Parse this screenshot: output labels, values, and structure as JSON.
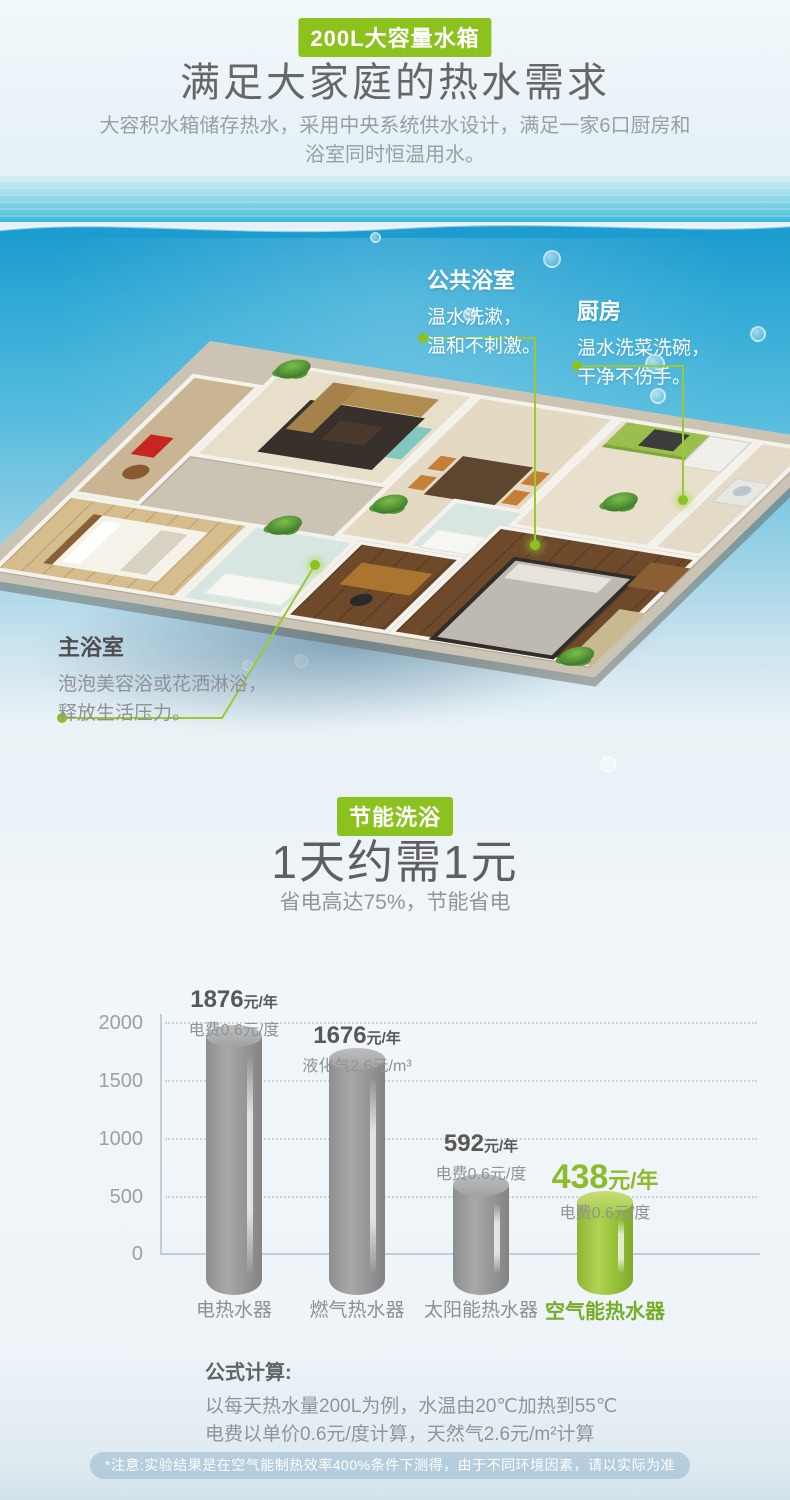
{
  "header": {
    "badge": "200L大容量水箱",
    "title": "满足大家庭的热水需求",
    "desc": "大容积水箱储存热水，采用中央系统供水设计，满足一家6口厨房和浴室同时恒温用水。"
  },
  "callouts": {
    "public_bath": {
      "title": "公共浴室",
      "line1": "温水洗漱，",
      "line2": "温和不刺激。"
    },
    "kitchen": {
      "title": "厨房",
      "line1": "温水洗菜洗碗，",
      "line2": "干净不伤手。"
    },
    "master_bath": {
      "title": "主浴室",
      "line1": "泡泡美容浴或花洒淋浴，",
      "line2": "释放生活压力。"
    }
  },
  "saving": {
    "badge": "节能洗浴",
    "title": "1天约需1元",
    "subtitle": "省电高达75%，节能省电"
  },
  "chart_data": {
    "type": "bar",
    "categories": [
      "电热水器",
      "燃气热水器",
      "太阳能热水器",
      "空气能热水器"
    ],
    "values": [
      1876,
      1676,
      592,
      438
    ],
    "unit": "元/年",
    "bars": [
      {
        "category": "电热水器",
        "value": "1876",
        "unit": "元/年",
        "note": "电费0.6元/度"
      },
      {
        "category": "燃气热水器",
        "value": "1676",
        "unit": "元/年",
        "note": "液化气2.6元/m³"
      },
      {
        "category": "太阳能热水器",
        "value": "592",
        "unit": "元/年",
        "note": "电费0.6元/度"
      },
      {
        "category": "空气能热水器",
        "value": "438",
        "unit": "元/年",
        "note": "电费0.6元/度"
      }
    ],
    "yticks": [
      "2000",
      "1500",
      "1000",
      "500",
      "0"
    ],
    "ylim": [
      0,
      2000
    ],
    "grid": "dotted-horizontal",
    "legend": "none",
    "bar_color": "#9b9b9b",
    "highlight_index": 3,
    "highlight_color": "#9cc53c"
  },
  "formula": {
    "title": "公式计算:",
    "line1": "以每天热水量200L为例，水温由20℃加热到55℃",
    "line2": "电费以单价0.6元/度计算，天然气2.6元/m²计算"
  },
  "footnote": "*注意:实验结果是在空气能制热效率400%条件下测得，由于不同环境因素，请以实际为准",
  "colors": {
    "accent_green": "#8cc21e",
    "water_blue": "#1d9ccf",
    "bar_gray": "#9b9b9b"
  }
}
